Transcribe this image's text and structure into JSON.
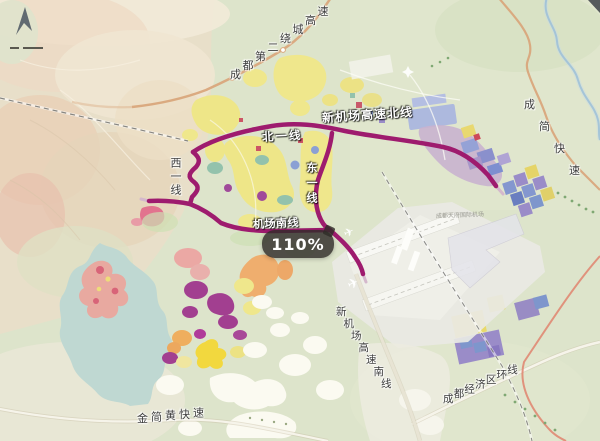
{
  "map": {
    "labels": {
      "second_ring": "成都第二绕城高速",
      "new_airport_north": "新机场高速北线",
      "north_line": "北一线",
      "west_line": "西一线",
      "east_line": "东一线",
      "airport_south_line": "机场南线",
      "new_airport_south": "新机场高速南线",
      "economic_ring": "成都经济区环线",
      "jinjianhuang_express": "金简黄快速",
      "chengjian_express": "成简快速",
      "airport_name": "成都天府国际机场"
    },
    "tooltip": {
      "value": "110%"
    },
    "colors": {
      "expressway": "#9e1b6e",
      "highway": "#d9a77c",
      "economic_ring_road": "#e08873",
      "lake": "#bfd8d2",
      "tooltip_bg": "rgba(48,44,40,0.82)"
    },
    "icons": {
      "compass": "north-compass-icon",
      "scale": "scale-bar"
    }
  }
}
